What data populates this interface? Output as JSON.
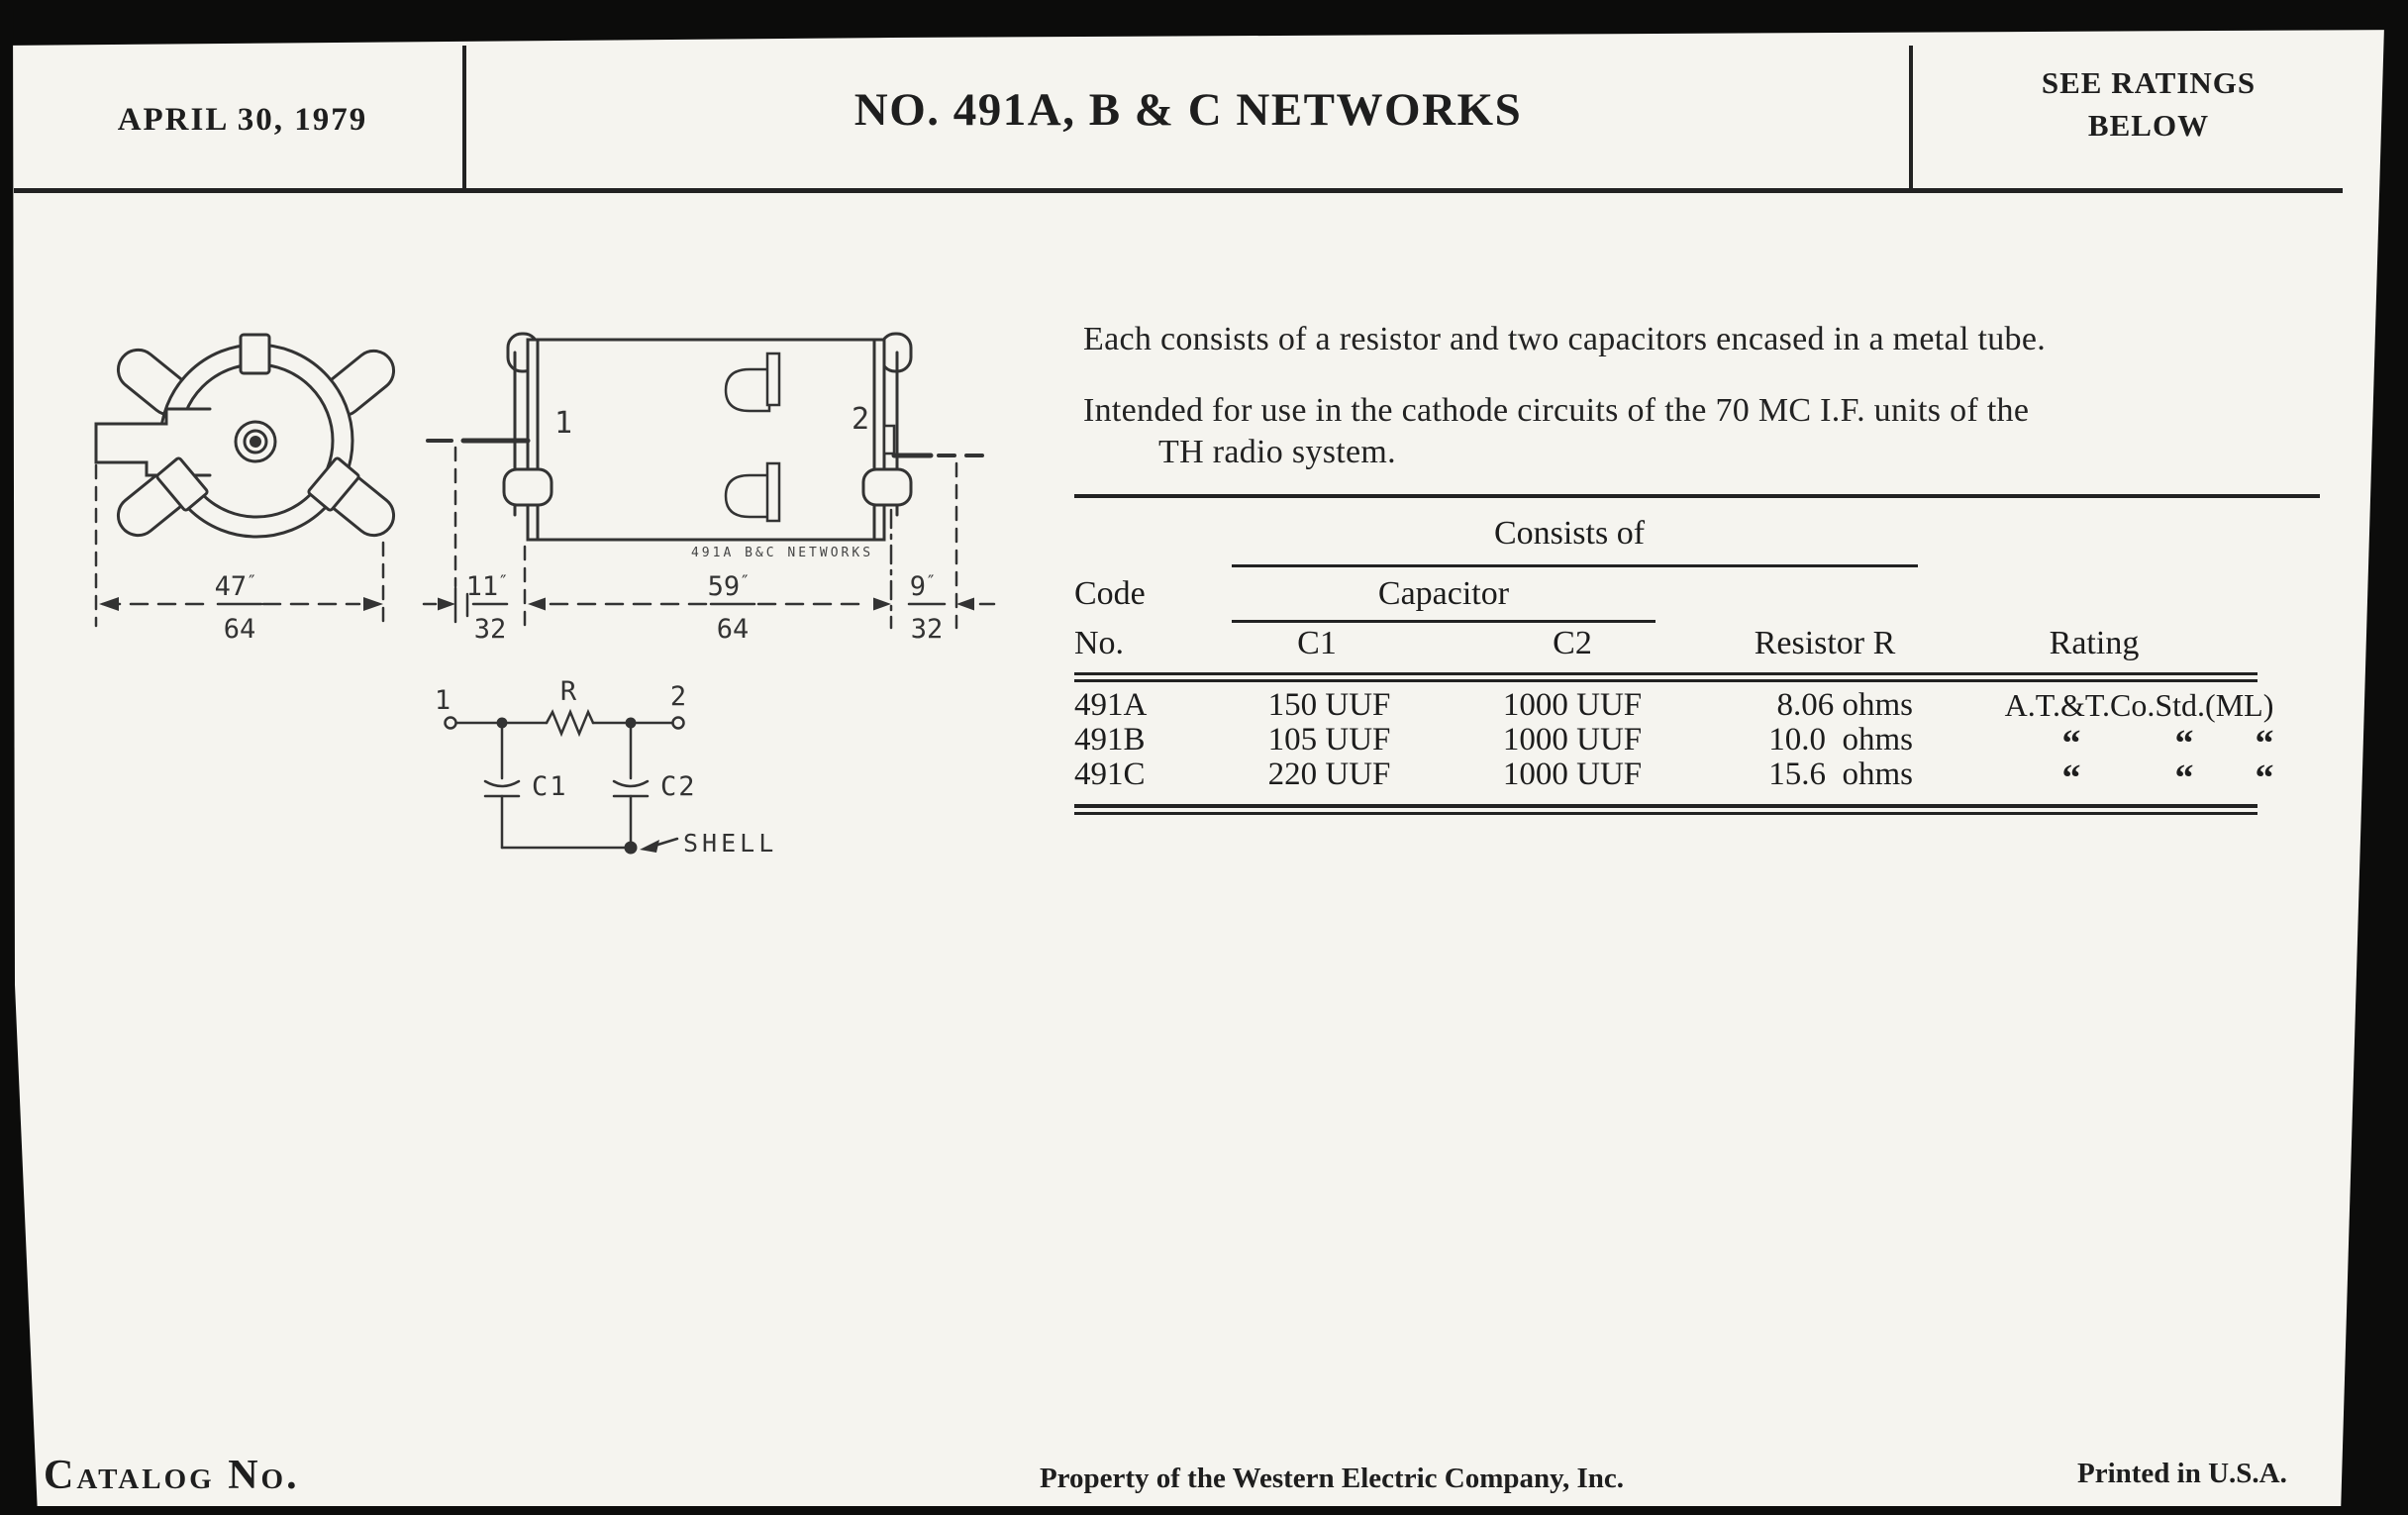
{
  "header": {
    "date": "APRIL 30, 1979",
    "title": "NO. 491A, B & C NETWORKS",
    "ratings_note_line1": "SEE RATINGS",
    "ratings_note_line2": "BELOW"
  },
  "description": {
    "para1": "Each consists of a resistor and two capacitors encased in a metal tube.",
    "para2_line1": "Intended for use in the cathode circuits of the 70 MC I.F. units of the",
    "para2_line2": "TH radio system."
  },
  "table": {
    "consists_of_label": "Consists of",
    "capacitor_label": "Capacitor",
    "code_label": "Code",
    "no_label": "No.",
    "c1_label": "C1",
    "c2_label": "C2",
    "resistor_label": "Resistor R",
    "rating_label": "Rating",
    "rows": [
      {
        "code": "491A",
        "c1": "150 UUF",
        "c2": "1000 UUF",
        "r": "8.06 ohms",
        "rating": "A.T.&T.Co.Std.(ML)"
      },
      {
        "code": "491B",
        "c1": "105 UUF",
        "c2": "1000 UUF",
        "r": "10.0  ohms",
        "dittos": [
          "“",
          "“",
          "“"
        ]
      },
      {
        "code": "491C",
        "c1": "220 UUF",
        "c2": "1000 UUF",
        "r": "15.6  ohms",
        "dittos": [
          "“",
          "“",
          "“"
        ]
      }
    ]
  },
  "drawings": {
    "inch_mark": "″",
    "end_view": {
      "dim_num": "47",
      "dim_denom": "64"
    },
    "side_view": {
      "terminal_1": "1",
      "terminal_2": "2",
      "stamp": "491A B&C NETWORKS",
      "dim_left_num": "11",
      "dim_left_denom": "32",
      "dim_mid_num": "59",
      "dim_mid_denom": "64",
      "dim_right_num": "9",
      "dim_right_denom": "32"
    },
    "schematic": {
      "terminal_1": "1",
      "terminal_2": "2",
      "resistor": "R",
      "cap_1": "C1",
      "cap_2": "C2",
      "shell": "SHELL"
    }
  },
  "footer": {
    "catalog": "Catalog No.",
    "property": "Property of the Western Electric Company, Inc.",
    "printed": "Printed in U.S.A."
  }
}
